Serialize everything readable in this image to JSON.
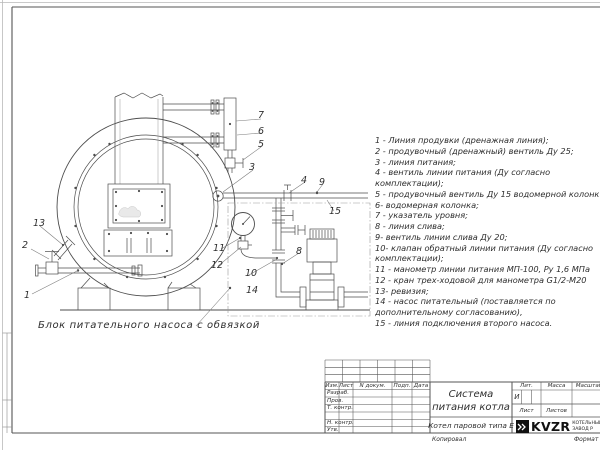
{
  "drawing": {
    "caption": "Блок питательного насоса с обвязкой",
    "callouts": [
      "1",
      "2",
      "3",
      "4",
      "5",
      "6",
      "7",
      "8",
      "9",
      "10",
      "11",
      "12",
      "13",
      "14",
      "15"
    ]
  },
  "legend": {
    "lines": [
      "1 -  Линия продувки (дренажная линия);",
      "2 -  продувочный (дренажный) вентиль Ду 25;",
      "3 -  линия питания;",
      "4 -  вентиль линии питания (Ду согласно",
      "комплектации);",
      "5 -  продувочный вентиль Ду 15 водомерной колонки",
      "6-  водомерная колонка;",
      "7 -  указатель уровня;",
      "8 -  линия слива;",
      "9-  вентиль линии слива Ду 20;",
      "10-  клапан обратный линии питания (Ду согласно",
      "комплектации);",
      "11 -  манометр линии питания МП-100, Ру 1,6 МПа",
      "12 -  кран трех-ходовой для манометра G1/2-М20",
      "13-  ревизия;",
      "14 -  насос питательный (поставляется по",
      "дополнительному согласованию),",
      "15 -  линия подключения второго насоса."
    ]
  },
  "title_block": {
    "header_cols": [
      "Изм.",
      "Лист",
      "N докум.",
      "Подп.",
      "Дата"
    ],
    "sign_rows": [
      "Разраб.",
      "Пров.",
      "Т. контр.",
      "Н. контр.",
      "Утв."
    ],
    "title_line1": "Система",
    "title_line2": "питания котла",
    "product": "Котел паровой типа Е",
    "lit_label": "Лит.",
    "lit_value": "И",
    "mass_label": "Масса",
    "scale_label": "Масштаб",
    "sheet_label": "Лист",
    "sheets_label": "Листов",
    "logo_text": "KVZR",
    "logo_sub1": "КОТЕЛЬНЫЙ",
    "logo_sub2": "ЗАВОД Р",
    "footer_copy": "Копировал",
    "footer_format": "Формат"
  }
}
